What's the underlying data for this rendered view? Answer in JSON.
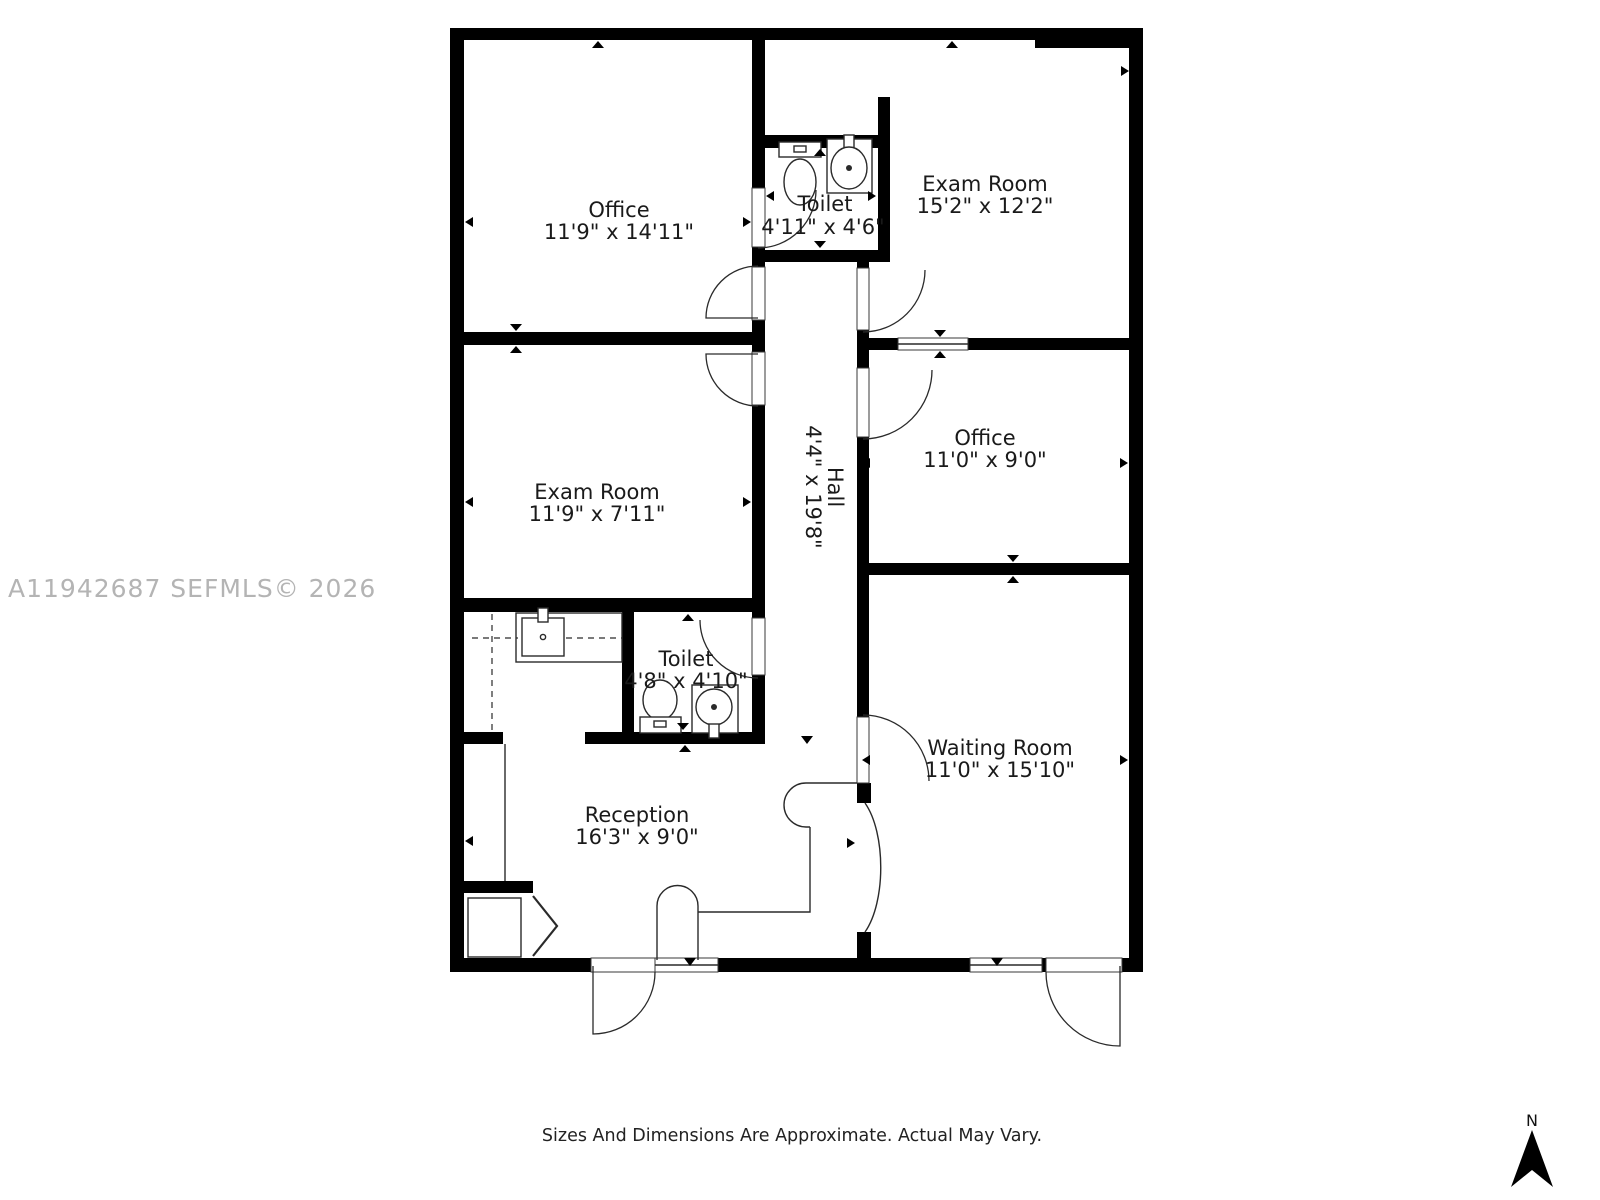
{
  "watermark": "A11942687  SEFMLS© 2026",
  "footer": "Sizes And Dimensions Are Approximate. Actual May Vary.",
  "compass": {
    "label": "N"
  },
  "rooms": {
    "office_top_left": {
      "name": "Office",
      "dims": "11'9\" x 14'11\""
    },
    "toilet_top": {
      "name": "Toilet",
      "dims": "4'11\" x 4'6\""
    },
    "exam_room_top_right": {
      "name": "Exam Room",
      "dims": "15'2\" x 12'2\""
    },
    "exam_room_left": {
      "name": "Exam Room",
      "dims": "11'9\" x 7'11\""
    },
    "hall": {
      "name": "Hall",
      "dims": "4'4\" x 19'8\""
    },
    "office_right": {
      "name": "Office",
      "dims": "11'0\" x 9'0\""
    },
    "toilet_lower": {
      "name": "Toilet",
      "dims": "4'8\" x 4'10\""
    },
    "waiting_room": {
      "name": "Waiting Room",
      "dims": "11'0\" x 15'10\""
    },
    "reception": {
      "name": "Reception",
      "dims": "16'3\" x 9'0\""
    }
  }
}
